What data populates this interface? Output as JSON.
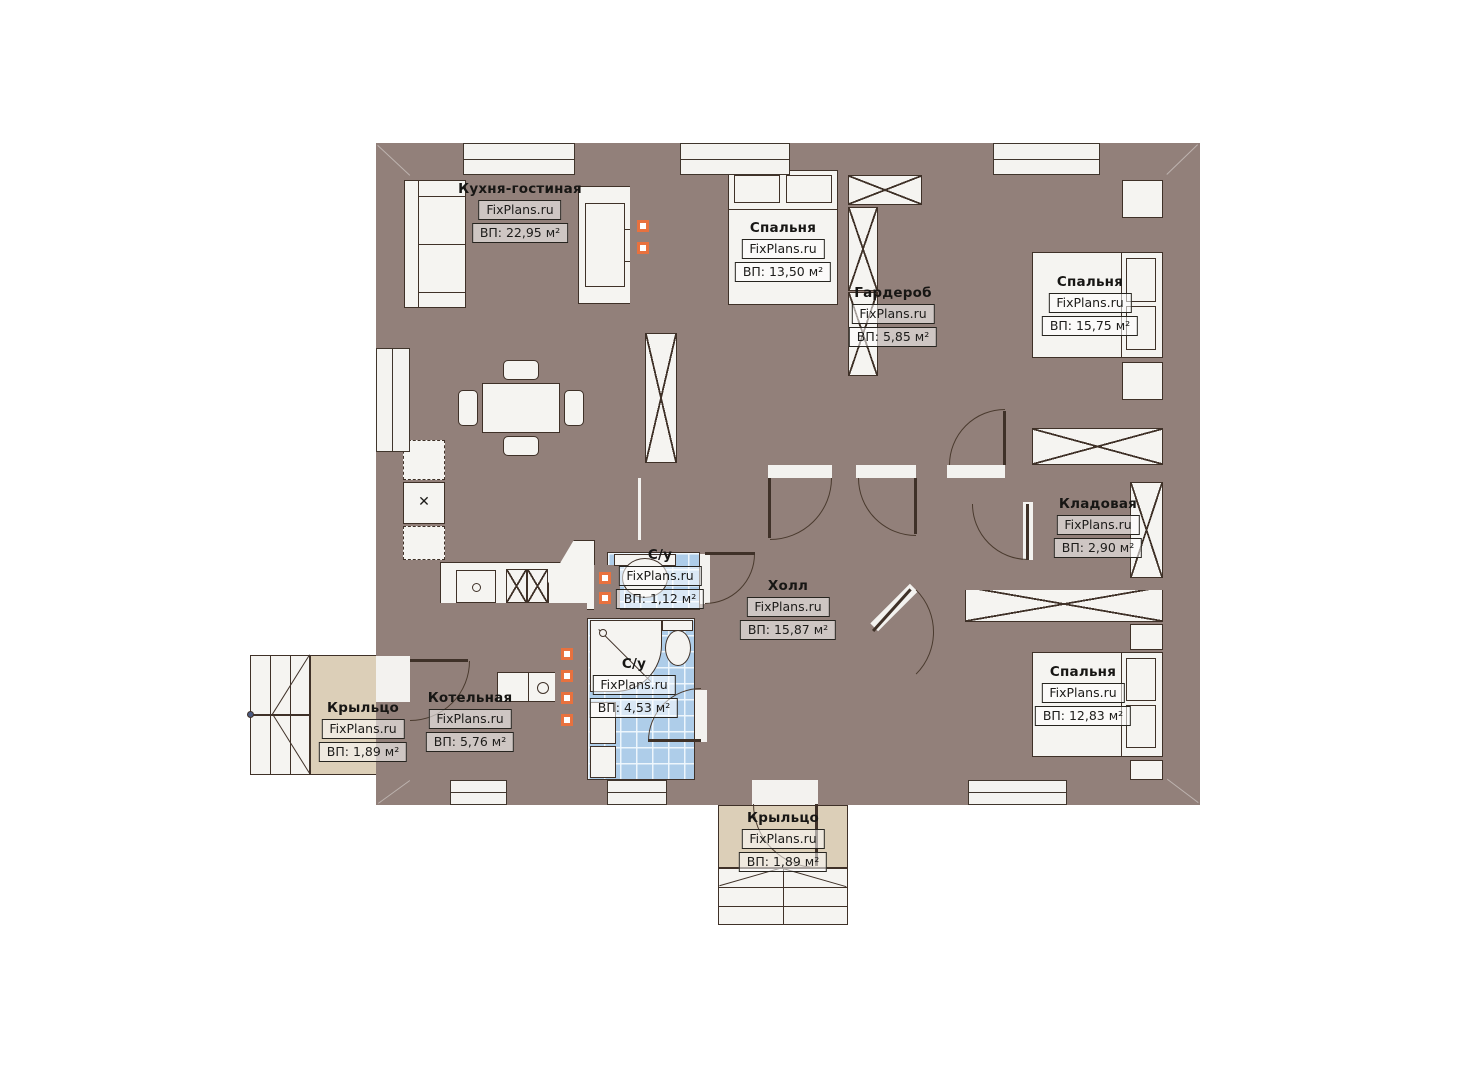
{
  "site": {
    "brand": "FixPlans.ru"
  },
  "rooms": [
    {
      "name": "Кухня-гостиная",
      "area": "ВП: 22,95 м²"
    },
    {
      "name": "Спальня",
      "area": "ВП: 13,50 м²"
    },
    {
      "name": "Гардероб",
      "area": "ВП: 5,85 м²"
    },
    {
      "name": "Спальня",
      "area": "ВП: 15,75 м²"
    },
    {
      "name": "Кладовая",
      "area": "ВП: 2,90 м²"
    },
    {
      "name": "Холл",
      "area": "ВП: 15,87 м²"
    },
    {
      "name": "С/у",
      "area": "ВП: 1,12 м²"
    },
    {
      "name": "С/у",
      "area": "ВП: 4,53 м²"
    },
    {
      "name": "Котельная",
      "area": "ВП: 5,76 м²"
    },
    {
      "name": "Спальня",
      "area": "ВП: 12,83 м²"
    },
    {
      "name": "Крыльцо",
      "area": "ВП: 1,89 м²"
    },
    {
      "name": "Крыльцо",
      "area": "ВП: 1,89 м²"
    }
  ],
  "icons": {
    "fridge_mark": "✕"
  },
  "colors": {
    "wall": "#92807A",
    "floor_tile_beige": "#D4BD94",
    "floor_wood_brown": "#97805F",
    "floor_bath_blue": "#AECDE9",
    "floor_boiler_gray": "#D8D8D6",
    "porch_beige": "#DCCFB8",
    "vent_accent_orange": "#E8713E"
  }
}
